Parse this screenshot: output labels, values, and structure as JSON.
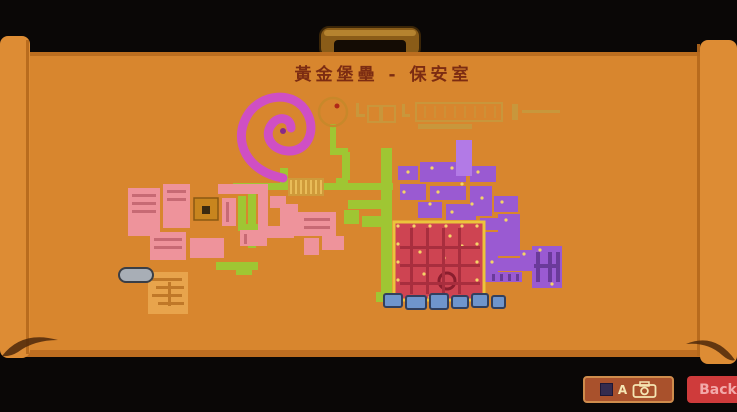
{
  "title": {
    "text": "黃金堡壘 - 保安室",
    "color": "#7c2c12"
  },
  "case": {
    "background": "#0a0706",
    "body_color": "#d8862e",
    "roll_color": "#dd8c34",
    "fold_color": "#b5681c",
    "edge_shadow": "#a85a15",
    "curl_shadow": "#4e280a",
    "handle_color": "#8a5c18",
    "handle_stripe": "#c89439",
    "handle_opening": "#140c04"
  },
  "toolbar": {
    "photo_button": {
      "key_label": "A",
      "bg": "#a9512c",
      "border": "#cf8c4c",
      "icon_color": "#f5e6b3"
    },
    "back_button": {
      "label": "Back",
      "bg": "#cf3b3b",
      "text_color": "#f2a9a9"
    }
  },
  "map": {
    "colors": {
      "green": "#9fc633",
      "pink": "#ee939b",
      "pink_detail": "#c76a74",
      "magenta_spiral": "#cf4fc4",
      "spiral_core": "#872a88",
      "ring": "#c8882a",
      "ring_dot": "#b02818",
      "tan": "#c69a3f",
      "purple": "#9a5ad2",
      "purple_light": "#b27ae6",
      "purple_dark": "#6a3a9a",
      "red": "#ce4452",
      "red_dark": "#a82e3e",
      "gold_border": "#ecc43c",
      "dot_yellow": "#f4d468",
      "blue": "#6f95cc",
      "blue_dark": "#32405e",
      "gray": "#a8aeb6",
      "amber": "#c8851e",
      "orange_room": "#e8a44c",
      "stripe_base": "#cf9a3a",
      "stripe_light": "#e9bc58"
    },
    "shapes": [
      {
        "name": "tan-outline-rooms",
        "fill": "none",
        "stroke": "#c69a3f",
        "strokeWidth": 2,
        "opacity": 0.8,
        "rects": [
          [
            368,
            106,
            12,
            16
          ],
          [
            382,
            106,
            13,
            16
          ],
          [
            416,
            103,
            86,
            18
          ]
        ]
      },
      {
        "name": "tan-fill-bits",
        "fill": "#c69a3f",
        "opacity": 0.85,
        "rects": [
          [
            418,
            124,
            54,
            5
          ],
          [
            512,
            104,
            6,
            16
          ],
          [
            522,
            110,
            38,
            3
          ],
          [
            356,
            103,
            3,
            14
          ],
          [
            356,
            114,
            9,
            3
          ],
          [
            402,
            104,
            3,
            12
          ],
          [
            402,
            114,
            8,
            3
          ]
        ]
      },
      {
        "name": "tan-corridor-ticks",
        "fill": "#c69a3f",
        "opacity": 0.5,
        "rects": [
          [
            424,
            106,
            2,
            12
          ],
          [
            434,
            106,
            2,
            12
          ],
          [
            444,
            106,
            2,
            12
          ],
          [
            454,
            106,
            2,
            12
          ],
          [
            464,
            106,
            2,
            12
          ],
          [
            474,
            106,
            2,
            12
          ],
          [
            484,
            106,
            2,
            12
          ],
          [
            494,
            106,
            2,
            12
          ]
        ]
      },
      {
        "name": "green-paths",
        "fill": "#9fc633",
        "rects": [
          [
            233,
            183,
            160,
            7
          ],
          [
            280,
            168,
            8,
            16
          ],
          [
            248,
            190,
            8,
            58
          ],
          [
            238,
            196,
            8,
            34
          ],
          [
            238,
            224,
            28,
            7
          ],
          [
            216,
            262,
            42,
            8
          ],
          [
            236,
            262,
            16,
            13
          ],
          [
            330,
            124,
            6,
            28
          ],
          [
            330,
            148,
            18,
            7
          ],
          [
            342,
            152,
            8,
            28
          ],
          [
            336,
            178,
            12,
            9
          ],
          [
            381,
            148,
            11,
            154
          ],
          [
            348,
            200,
            36,
            9
          ],
          [
            344,
            210,
            15,
            14
          ],
          [
            362,
            216,
            24,
            11
          ],
          [
            376,
            292,
            16,
            10
          ]
        ]
      },
      {
        "name": "pink-rooms",
        "fill": "#ee939b",
        "rects": [
          [
            128,
            188,
            32,
            48
          ],
          [
            163,
            184,
            27,
            44
          ],
          [
            150,
            232,
            36,
            28
          ],
          [
            190,
            238,
            34,
            20
          ],
          [
            218,
            184,
            42,
            10
          ],
          [
            222,
            198,
            14,
            28
          ],
          [
            240,
            230,
            27,
            16
          ],
          [
            258,
            184,
            10,
            48
          ],
          [
            270,
            196,
            16,
            12
          ],
          [
            262,
            226,
            32,
            12
          ],
          [
            280,
            204,
            18,
            32
          ],
          [
            298,
            212,
            38,
            24
          ],
          [
            322,
            236,
            22,
            14
          ],
          [
            304,
            238,
            15,
            17
          ]
        ]
      },
      {
        "name": "pink-room-details",
        "fill": "#c76a74",
        "rects": [
          [
            132,
            194,
            24,
            3
          ],
          [
            132,
            202,
            24,
            3
          ],
          [
            132,
            210,
            24,
            3
          ],
          [
            167,
            190,
            19,
            3
          ],
          [
            167,
            198,
            19,
            3
          ],
          [
            154,
            238,
            28,
            3
          ],
          [
            154,
            246,
            28,
            3
          ],
          [
            244,
            234,
            3,
            10
          ],
          [
            226,
            202,
            3,
            20
          ],
          [
            304,
            218,
            26,
            3
          ],
          [
            304,
            226,
            26,
            3
          ]
        ]
      },
      {
        "name": "striped-room",
        "fill": "#cf9a3a",
        "rects": [
          [
            288,
            178,
            36,
            18
          ]
        ]
      },
      {
        "name": "striped-room-stripes",
        "fill": "#e9bc58",
        "rects": [
          [
            290,
            180,
            2,
            14
          ],
          [
            295,
            180,
            2,
            14
          ],
          [
            300,
            180,
            2,
            14
          ],
          [
            305,
            180,
            2,
            14
          ],
          [
            310,
            180,
            2,
            14
          ],
          [
            315,
            180,
            2,
            14
          ],
          [
            320,
            180,
            2,
            14
          ]
        ]
      },
      {
        "name": "amber-room",
        "fill": "#c8851e",
        "stroke": "#8a5812",
        "strokeWidth": 1.5,
        "rects": [
          [
            194,
            198,
            24,
            22
          ]
        ]
      },
      {
        "name": "amber-room-core",
        "fill": "#3a2a10",
        "rects": [
          [
            202,
            206,
            8,
            8
          ]
        ]
      },
      {
        "name": "orange-maze-room",
        "fill": "#e8a44c",
        "rects": [
          [
            148,
            272,
            40,
            42
          ]
        ]
      },
      {
        "name": "orange-maze-lines",
        "fill": "#c07828",
        "rects": [
          [
            152,
            278,
            30,
            3
          ],
          [
            156,
            286,
            28,
            3
          ],
          [
            152,
            294,
            30,
            3
          ],
          [
            158,
            302,
            26,
            3
          ],
          [
            168,
            282,
            3,
            24
          ]
        ]
      },
      {
        "name": "gray-submarine",
        "fill": "#a8aeb6",
        "stroke": "#3a3e46",
        "strokeWidth": 2,
        "rx": 7,
        "rects": [
          [
            119,
            268,
            34,
            14
          ]
        ]
      },
      {
        "name": "purple-rooms",
        "fill": "#9a5ad2",
        "rects": [
          [
            398,
            166,
            20,
            14
          ],
          [
            420,
            162,
            46,
            20
          ],
          [
            400,
            184,
            26,
            16
          ],
          [
            430,
            186,
            36,
            14
          ],
          [
            418,
            202,
            24,
            16
          ],
          [
            446,
            204,
            30,
            16
          ],
          [
            470,
            166,
            26,
            16
          ],
          [
            470,
            186,
            22,
            30
          ],
          [
            494,
            196,
            24,
            16
          ],
          [
            480,
            218,
            36,
            12
          ],
          [
            498,
            214,
            22,
            42
          ],
          [
            484,
            232,
            14,
            50
          ],
          [
            520,
            250,
            18,
            16
          ],
          [
            486,
            258,
            48,
            13
          ],
          [
            488,
            272,
            34,
            10
          ],
          [
            532,
            246,
            30,
            42
          ]
        ],
        "dots": [
          [
            408,
            172
          ],
          [
            432,
            168
          ],
          [
            452,
            168
          ],
          [
            462,
            184
          ],
          [
            404,
            192
          ],
          [
            438,
            192
          ],
          [
            452,
            212
          ],
          [
            478,
            172
          ],
          [
            482,
            198
          ],
          [
            502,
            202
          ],
          [
            506,
            220
          ],
          [
            492,
            262
          ],
          [
            524,
            254
          ],
          [
            540,
            250
          ],
          [
            552,
            284
          ],
          [
            472,
            204
          ],
          [
            430,
            204
          ]
        ],
        "dotColor": "#f4d468"
      },
      {
        "name": "purple-room-tower",
        "fill": "#b27ae6",
        "rects": [
          [
            456,
            140,
            16,
            36
          ]
        ]
      },
      {
        "name": "purple-details",
        "fill": "#6a3a9a",
        "rects": [
          [
            536,
            252,
            4,
            30
          ],
          [
            548,
            252,
            4,
            30
          ],
          [
            556,
            252,
            4,
            30
          ],
          [
            492,
            274,
            3,
            7
          ],
          [
            500,
            274,
            3,
            7
          ],
          [
            508,
            274,
            3,
            7
          ],
          [
            516,
            274,
            3,
            7
          ],
          [
            534,
            264,
            26,
            4
          ]
        ]
      },
      {
        "name": "red-fortress",
        "fill": "#ce4452",
        "stroke": "#ecc43c",
        "strokeWidth": 3,
        "rects": [
          [
            394,
            222,
            90,
            78
          ]
        ],
        "dots": [
          [
            398,
            226
          ],
          [
            414,
            226
          ],
          [
            430,
            226
          ],
          [
            446,
            226
          ],
          [
            462,
            226
          ],
          [
            477,
            226
          ],
          [
            398,
            244
          ],
          [
            398,
            262
          ],
          [
            398,
            280
          ],
          [
            398,
            296
          ],
          [
            477,
            244
          ],
          [
            477,
            262
          ],
          [
            477,
            280
          ],
          [
            477,
            296
          ],
          [
            414,
            297
          ],
          [
            430,
            297
          ],
          [
            446,
            297
          ],
          [
            462,
            297
          ],
          [
            420,
            252
          ],
          [
            444,
            258
          ],
          [
            462,
            246
          ],
          [
            424,
            274
          ],
          [
            450,
            236
          ]
        ],
        "dotColor": "#f4d468",
        "rings": [
          [
            447,
            281,
            8
          ]
        ],
        "ringColor": "#8a1e2e",
        "ringWidth": 3
      },
      {
        "name": "red-fortress-grid",
        "fill": "#a82e3e",
        "rects": [
          [
            410,
            228,
            3,
            66
          ],
          [
            426,
            228,
            3,
            66
          ],
          [
            442,
            228,
            3,
            66
          ],
          [
            458,
            228,
            3,
            66
          ],
          [
            400,
            246,
            80,
            3
          ],
          [
            400,
            264,
            80,
            3
          ],
          [
            400,
            282,
            80,
            3
          ]
        ]
      },
      {
        "name": "blue-supports",
        "fill": "#6f95cc",
        "stroke": "#32405e",
        "strokeWidth": 2,
        "rx": 2,
        "rects": [
          [
            384,
            294,
            18,
            13
          ],
          [
            406,
            296,
            20,
            13
          ],
          [
            430,
            294,
            18,
            15
          ],
          [
            452,
            296,
            16,
            12
          ],
          [
            472,
            294,
            16,
            13
          ],
          [
            492,
            296,
            13,
            12
          ]
        ]
      }
    ]
  }
}
